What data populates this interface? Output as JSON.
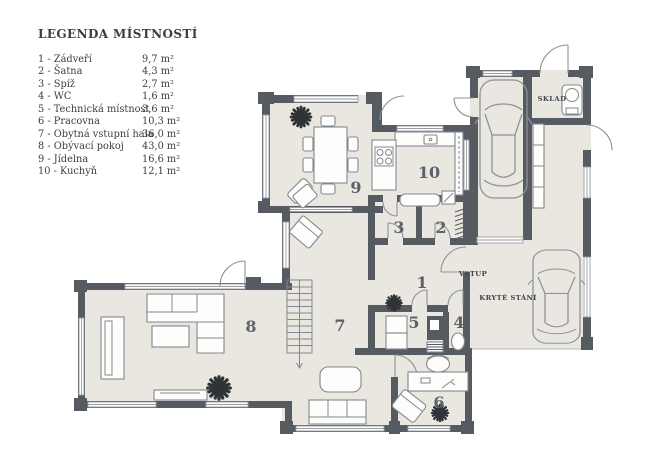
{
  "legend": {
    "title": "LEGENDA MÍSTNOSTÍ",
    "items": [
      {
        "label": "1 - Zádveří",
        "area": "9,7 m²"
      },
      {
        "label": "2 - Šatna",
        "area": "4,3 m²"
      },
      {
        "label": "3 - Spíž",
        "area": "2,7 m²"
      },
      {
        "label": "4 - WC",
        "area": "1,6 m²"
      },
      {
        "label": "5 - Technická místnost",
        "area": "3,6 m²"
      },
      {
        "label": "6 - Pracovna",
        "area": "10,3 m²"
      },
      {
        "label": "7 - Obytná vstupní hala",
        "area": "36,0 m²"
      },
      {
        "label": "8 - Obývací pokoj",
        "area": "43,0 m²"
      },
      {
        "label": "9 - Jídelna",
        "area": "16,6 m²"
      },
      {
        "label": "10 - Kuchyň",
        "area": "12,1 m²"
      }
    ]
  },
  "plan": {
    "rooms": [
      {
        "number": "1"
      },
      {
        "number": "2"
      },
      {
        "number": "3"
      },
      {
        "number": "4"
      },
      {
        "number": "5"
      },
      {
        "number": "6"
      },
      {
        "number": "7"
      },
      {
        "number": "8"
      },
      {
        "number": "9"
      },
      {
        "number": "10"
      }
    ],
    "labels": {
      "vstup": "VSTUP",
      "kryte_stani": "KRYTÉ STÁNÍ",
      "sklad": "SKLAD"
    }
  },
  "colors": {
    "wall": "#565b62",
    "floor": "#e9e7df",
    "furniture_outline": "#82888f",
    "text": "#3e444a"
  }
}
